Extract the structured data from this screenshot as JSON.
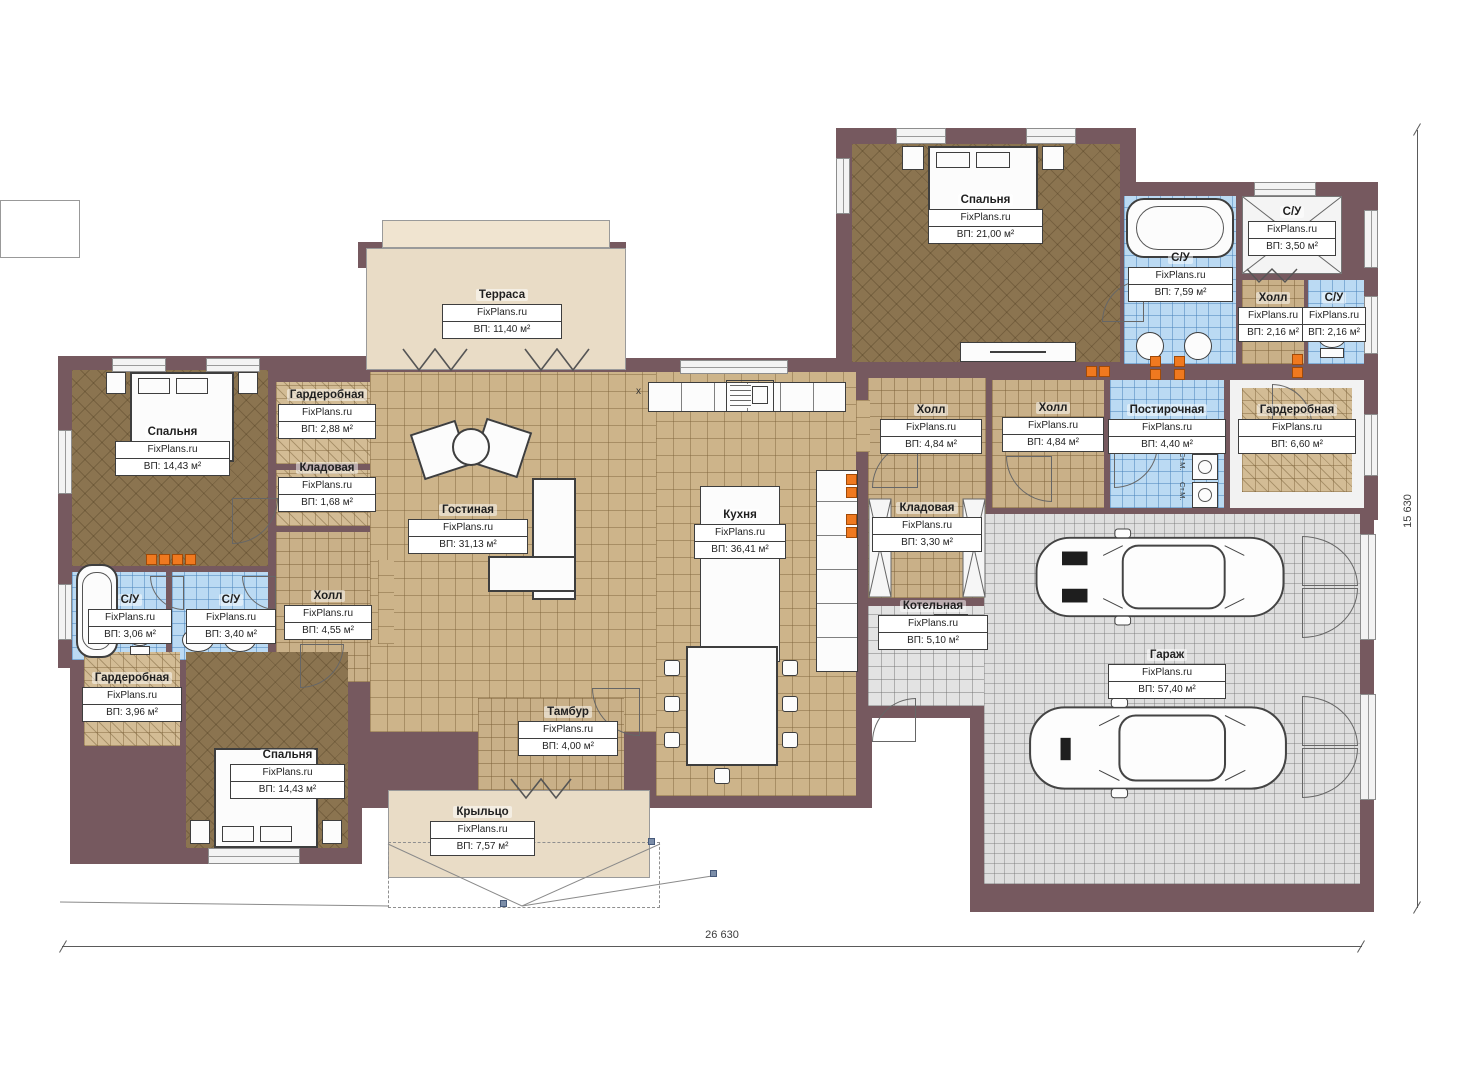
{
  "plan": {
    "brand": "FixPlans.ru",
    "dimensions": {
      "width": "26 630",
      "height": "15 630"
    },
    "marks": {
      "washer": "Ст.М.",
      "counter": "x"
    },
    "colors": {
      "wall": "#76595f",
      "floor_dark": "#8b7450",
      "floor_light": "#cdb48a",
      "tile_blue": "#bbdaf3",
      "garage_gray": "#dedede",
      "terrace_beige": "#e9dcc6",
      "radiator_orange": "#f0791f"
    },
    "rooms": {
      "terrace": {
        "name": "Терраса",
        "area": "ВП: 11,40 м²"
      },
      "bedroom_tr": {
        "name": "Спальня",
        "area": "ВП: 21,00 м²"
      },
      "bath_master": {
        "name": "С/У",
        "area": "ВП: 7,59 м²"
      },
      "bath_tr": {
        "name": "С/У",
        "area": "ВП: 3,50 м²"
      },
      "hall_tr": {
        "name": "Холл",
        "area": "ВП: 2,16 м²"
      },
      "wc_tr": {
        "name": "С/У",
        "area": "ВП: 2,16 м²"
      },
      "hall_kitchen": {
        "name": "Холл",
        "area": "ВП: 4,84 м²"
      },
      "hall_garage": {
        "name": "Холл",
        "area": "ВП: 4,84 м²"
      },
      "laundry": {
        "name": "Постирочная",
        "area": "ВП: 4,40 м²"
      },
      "wardrobe_r": {
        "name": "Гардеробная",
        "area": "ВП: 6,60 м²"
      },
      "pantry_k": {
        "name": "Кладовая",
        "area": "ВП: 3,30 м²"
      },
      "boiler": {
        "name": "Котельная",
        "area": "ВП: 5,10 м²"
      },
      "garage": {
        "name": "Гараж",
        "area": "ВП: 57,40 м²"
      },
      "living": {
        "name": "Гостиная",
        "area": "ВП: 31,13 м²"
      },
      "kitchen": {
        "name": "Кухня",
        "area": "ВП: 36,41 м²"
      },
      "bedroom_l": {
        "name": "Спальня",
        "area": "ВП: 14,43 м²"
      },
      "wardrobe_tl": {
        "name": "Гардеробная",
        "area": "ВП: 2,88 м²"
      },
      "pantry_l": {
        "name": "Кладовая",
        "area": "ВП: 1,68 м²"
      },
      "hall_l": {
        "name": "Холл",
        "area": "ВП: 4,55 м²"
      },
      "bath_l1": {
        "name": "С/У",
        "area": "ВП: 3,06 м²"
      },
      "bath_l2": {
        "name": "С/У",
        "area": "ВП: 3,40 м²"
      },
      "wardrobe_bl": {
        "name": "Гардеробная",
        "area": "ВП: 3,96 м²"
      },
      "bedroom_bl": {
        "name": "Спальня",
        "area": "ВП: 14,43 м²"
      },
      "tambour": {
        "name": "Тамбур",
        "area": "ВП: 4,00 м²"
      },
      "porch": {
        "name": "Крыльцо",
        "area": "ВП: 7,57 м²"
      }
    }
  }
}
